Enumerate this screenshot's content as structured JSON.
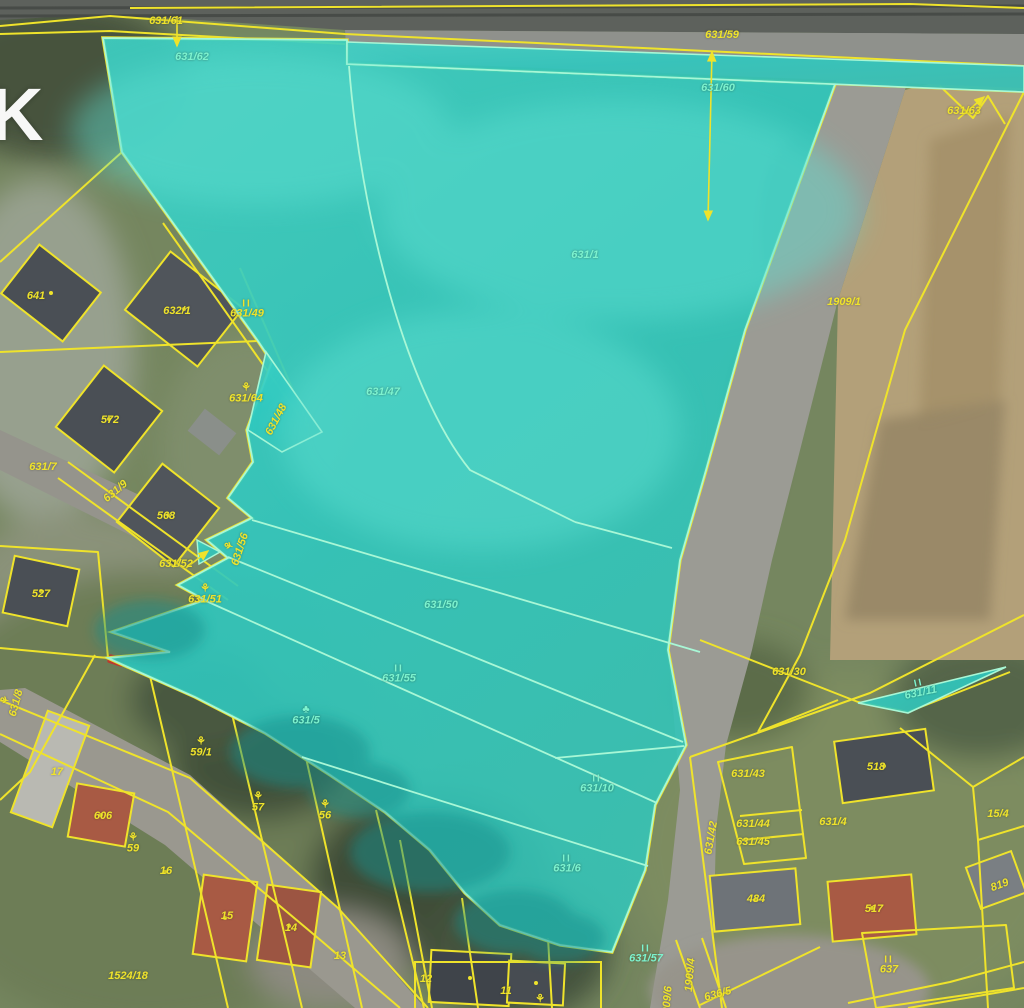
{
  "map": {
    "watermark": "K",
    "colors": {
      "parcel_line_yellow": "#efe32b",
      "selection_fill": "#2fc8bf",
      "selection_inner_stroke": "#a8f7d6",
      "label_teal": "#7df3cf",
      "road_grey": "#9b9b94",
      "farmland_tan": "#b3a079",
      "building_dark_roof": "#4a4f55",
      "building_red_roof": "#a85a44"
    },
    "symbol_glyphs": {
      "meadow": "II",
      "garden": "⚘",
      "tree": "♣"
    },
    "labels": [
      {
        "text": "631/61",
        "x": 166,
        "y": 22,
        "color": "yellow"
      },
      {
        "text": "631/59",
        "x": 722,
        "y": 36,
        "color": "yellow"
      },
      {
        "text": "631/63",
        "x": 964,
        "y": 112,
        "color": "yellow"
      },
      {
        "text": "641",
        "x": 36,
        "y": 297,
        "color": "yellow"
      },
      {
        "text": "632/1",
        "x": 177,
        "y": 312,
        "color": "yellow"
      },
      {
        "text": "631/49",
        "x": 247,
        "y": 310,
        "color": "yellow",
        "symbol": "meadow"
      },
      {
        "text": "631/64",
        "x": 246,
        "y": 394,
        "color": "yellow",
        "symbol": "garden"
      },
      {
        "text": "572",
        "x": 110,
        "y": 421,
        "color": "yellow"
      },
      {
        "text": "631/7",
        "x": 43,
        "y": 468,
        "color": "yellow"
      },
      {
        "text": "631/9",
        "x": 116,
        "y": 492,
        "color": "yellow",
        "rot": -40
      },
      {
        "text": "568",
        "x": 166,
        "y": 517,
        "color": "yellow"
      },
      {
        "text": "631/56",
        "x": 236,
        "y": 548,
        "color": "yellow",
        "rot": -72,
        "symbol": "garden"
      },
      {
        "text": "631/52",
        "x": 176,
        "y": 565,
        "color": "yellow"
      },
      {
        "text": "631/51",
        "x": 205,
        "y": 595,
        "color": "yellow",
        "symbol": "garden"
      },
      {
        "text": "527",
        "x": 41,
        "y": 595,
        "color": "yellow"
      },
      {
        "text": "1909/1",
        "x": 844,
        "y": 303,
        "color": "yellow"
      },
      {
        "text": "631/30",
        "x": 789,
        "y": 673,
        "color": "yellow"
      },
      {
        "text": "631/8",
        "x": 12,
        "y": 702,
        "color": "yellow",
        "rot": -75,
        "symbol": "garden"
      },
      {
        "text": "17",
        "x": 57,
        "y": 773,
        "color": "yellow"
      },
      {
        "text": "59/1",
        "x": 201,
        "y": 748,
        "color": "yellow",
        "symbol": "garden"
      },
      {
        "text": "606",
        "x": 103,
        "y": 817,
        "color": "yellow"
      },
      {
        "text": "59",
        "x": 133,
        "y": 844,
        "color": "yellow",
        "symbol": "garden"
      },
      {
        "text": "57",
        "x": 258,
        "y": 803,
        "color": "yellow",
        "symbol": "garden"
      },
      {
        "text": "56",
        "x": 325,
        "y": 811,
        "color": "yellow",
        "symbol": "garden"
      },
      {
        "text": "16",
        "x": 166,
        "y": 872,
        "color": "yellow"
      },
      {
        "text": "15",
        "x": 227,
        "y": 917,
        "color": "yellow"
      },
      {
        "text": "14",
        "x": 291,
        "y": 929,
        "color": "yellow"
      },
      {
        "text": "13",
        "x": 340,
        "y": 957,
        "color": "yellow"
      },
      {
        "text": "1524/18",
        "x": 128,
        "y": 977,
        "color": "yellow"
      },
      {
        "text": "12",
        "x": 426,
        "y": 980,
        "color": "yellow"
      },
      {
        "text": "11",
        "x": 506,
        "y": 992,
        "color": "yellow"
      },
      {
        "text": "631/43",
        "x": 748,
        "y": 775,
        "color": "yellow"
      },
      {
        "text": "631/44",
        "x": 753,
        "y": 825,
        "color": "yellow"
      },
      {
        "text": "631/45",
        "x": 753,
        "y": 843,
        "color": "yellow"
      },
      {
        "text": "631/42",
        "x": 712,
        "y": 838,
        "color": "yellow",
        "rot": -80
      },
      {
        "text": "631/4",
        "x": 833,
        "y": 823,
        "color": "yellow"
      },
      {
        "text": "518",
        "x": 876,
        "y": 768,
        "color": "yellow"
      },
      {
        "text": "15/4",
        "x": 998,
        "y": 815,
        "color": "yellow"
      },
      {
        "text": "484",
        "x": 756,
        "y": 900,
        "color": "yellow"
      },
      {
        "text": "517",
        "x": 874,
        "y": 910,
        "color": "yellow"
      },
      {
        "text": "637",
        "x": 889,
        "y": 966,
        "color": "yellow",
        "symbol": "meadow"
      },
      {
        "text": "819",
        "x": 1000,
        "y": 886,
        "color": "yellow",
        "rot": -20
      },
      {
        "text": "1909/4",
        "x": 691,
        "y": 975,
        "color": "yellow",
        "rot": -85
      },
      {
        "text": "636/5",
        "x": 718,
        "y": 995,
        "color": "yellow",
        "rot": -15
      },
      {
        "text": "1909/6",
        "x": 668,
        "y": 1003,
        "color": "yellow",
        "rot": -85
      },
      {
        "text": "631/48",
        "x": 277,
        "y": 420,
        "color": "yellow",
        "rot": -62
      },
      {
        "text": "",
        "x": 540,
        "y": 1000,
        "color": "yellow",
        "symbol": "garden"
      },
      {
        "text": "631/62",
        "x": 192,
        "y": 58,
        "color": "teal"
      },
      {
        "text": "631/60",
        "x": 718,
        "y": 89,
        "color": "teal"
      },
      {
        "text": "631/1",
        "x": 585,
        "y": 256,
        "color": "teal"
      },
      {
        "text": "631/47",
        "x": 383,
        "y": 393,
        "color": "teal"
      },
      {
        "text": "631/50",
        "x": 441,
        "y": 606,
        "color": "teal"
      },
      {
        "text": "631/55",
        "x": 399,
        "y": 675,
        "color": "teal",
        "symbol": "meadow"
      },
      {
        "text": "631/5",
        "x": 306,
        "y": 716,
        "color": "teal",
        "symbol": "tree"
      },
      {
        "text": "631/10",
        "x": 597,
        "y": 785,
        "color": "teal",
        "symbol": "meadow"
      },
      {
        "text": "631/6",
        "x": 567,
        "y": 865,
        "color": "teal",
        "symbol": "meadow"
      },
      {
        "text": "631/11",
        "x": 920,
        "y": 689,
        "color": "teal",
        "symbol": "meadow",
        "rot": -12
      },
      {
        "text": "631/57",
        "x": 646,
        "y": 955,
        "color": "teal",
        "symbol": "meadow"
      }
    ]
  }
}
